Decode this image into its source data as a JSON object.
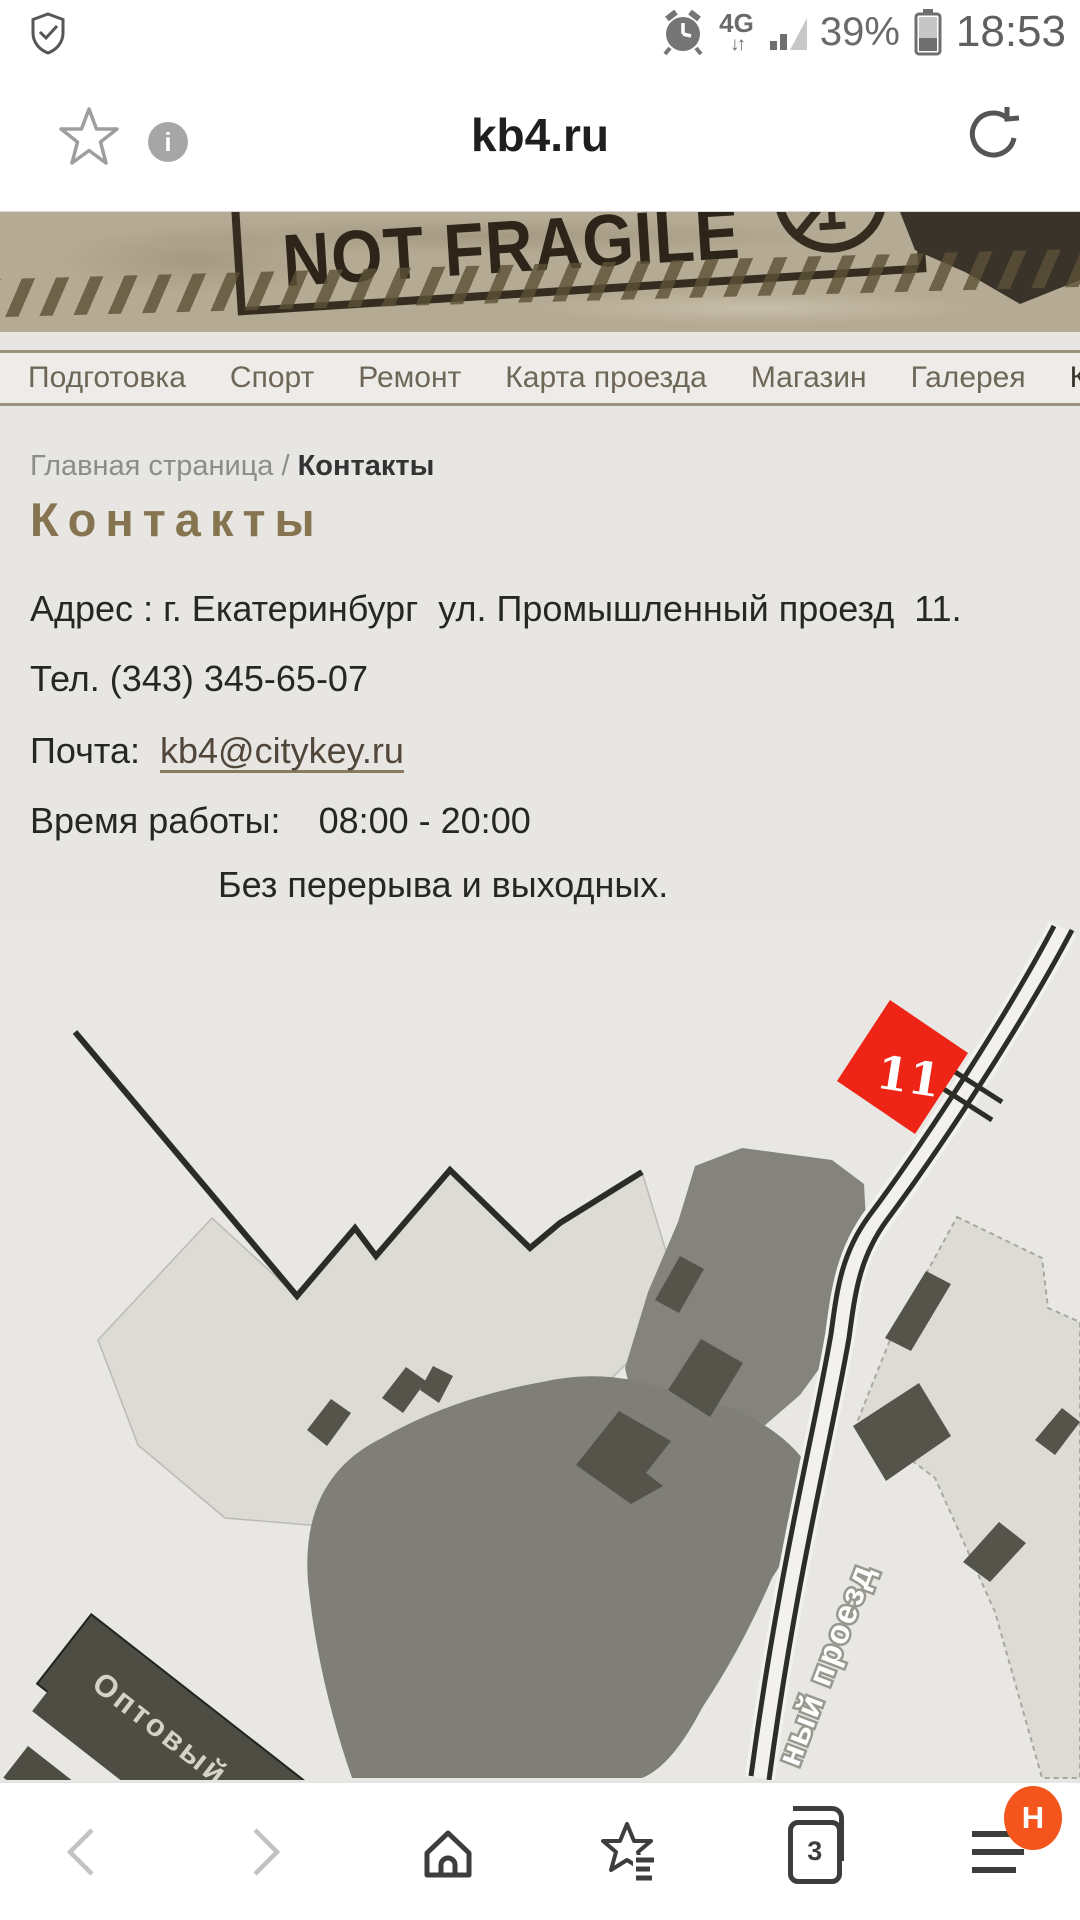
{
  "status_bar": {
    "time": "18:53",
    "battery": "39%",
    "network": "4G",
    "arrows": "↓↑"
  },
  "browser": {
    "title": "kb4.ru",
    "info_glyph": "i"
  },
  "header": {
    "stamp_text": "NOT FRAGILE"
  },
  "nav": {
    "items": [
      {
        "label": "Подготовка"
      },
      {
        "label": "Спорт"
      },
      {
        "label": "Ремонт"
      },
      {
        "label": "Карта проезда"
      },
      {
        "label": "Магазин"
      },
      {
        "label": "Галерея"
      },
      {
        "label": "Контакты"
      }
    ]
  },
  "breadcrumb": {
    "home": "Главная страница",
    "separator": " / ",
    "current": "Контакты"
  },
  "content": {
    "title": "Контакты",
    "address": "Адрес : г. Екатеринбург  ул. Промышленный проезд  11.",
    "phone": "Тел. (343) 345-65-07",
    "email_label": "Почта:  ",
    "email": "kb4@citykey.ru",
    "hours_label": "Время работы:",
    "hours": "08:00 - 20:00",
    "hours_note": "Без перерыва и выходных."
  },
  "map": {
    "marker_label": "11",
    "marker_color": "#ee2417",
    "road_label": "ный проезд",
    "building_label": "Оптовый ры"
  },
  "toolbar": {
    "tabs_count": "3",
    "badge": "H"
  }
}
